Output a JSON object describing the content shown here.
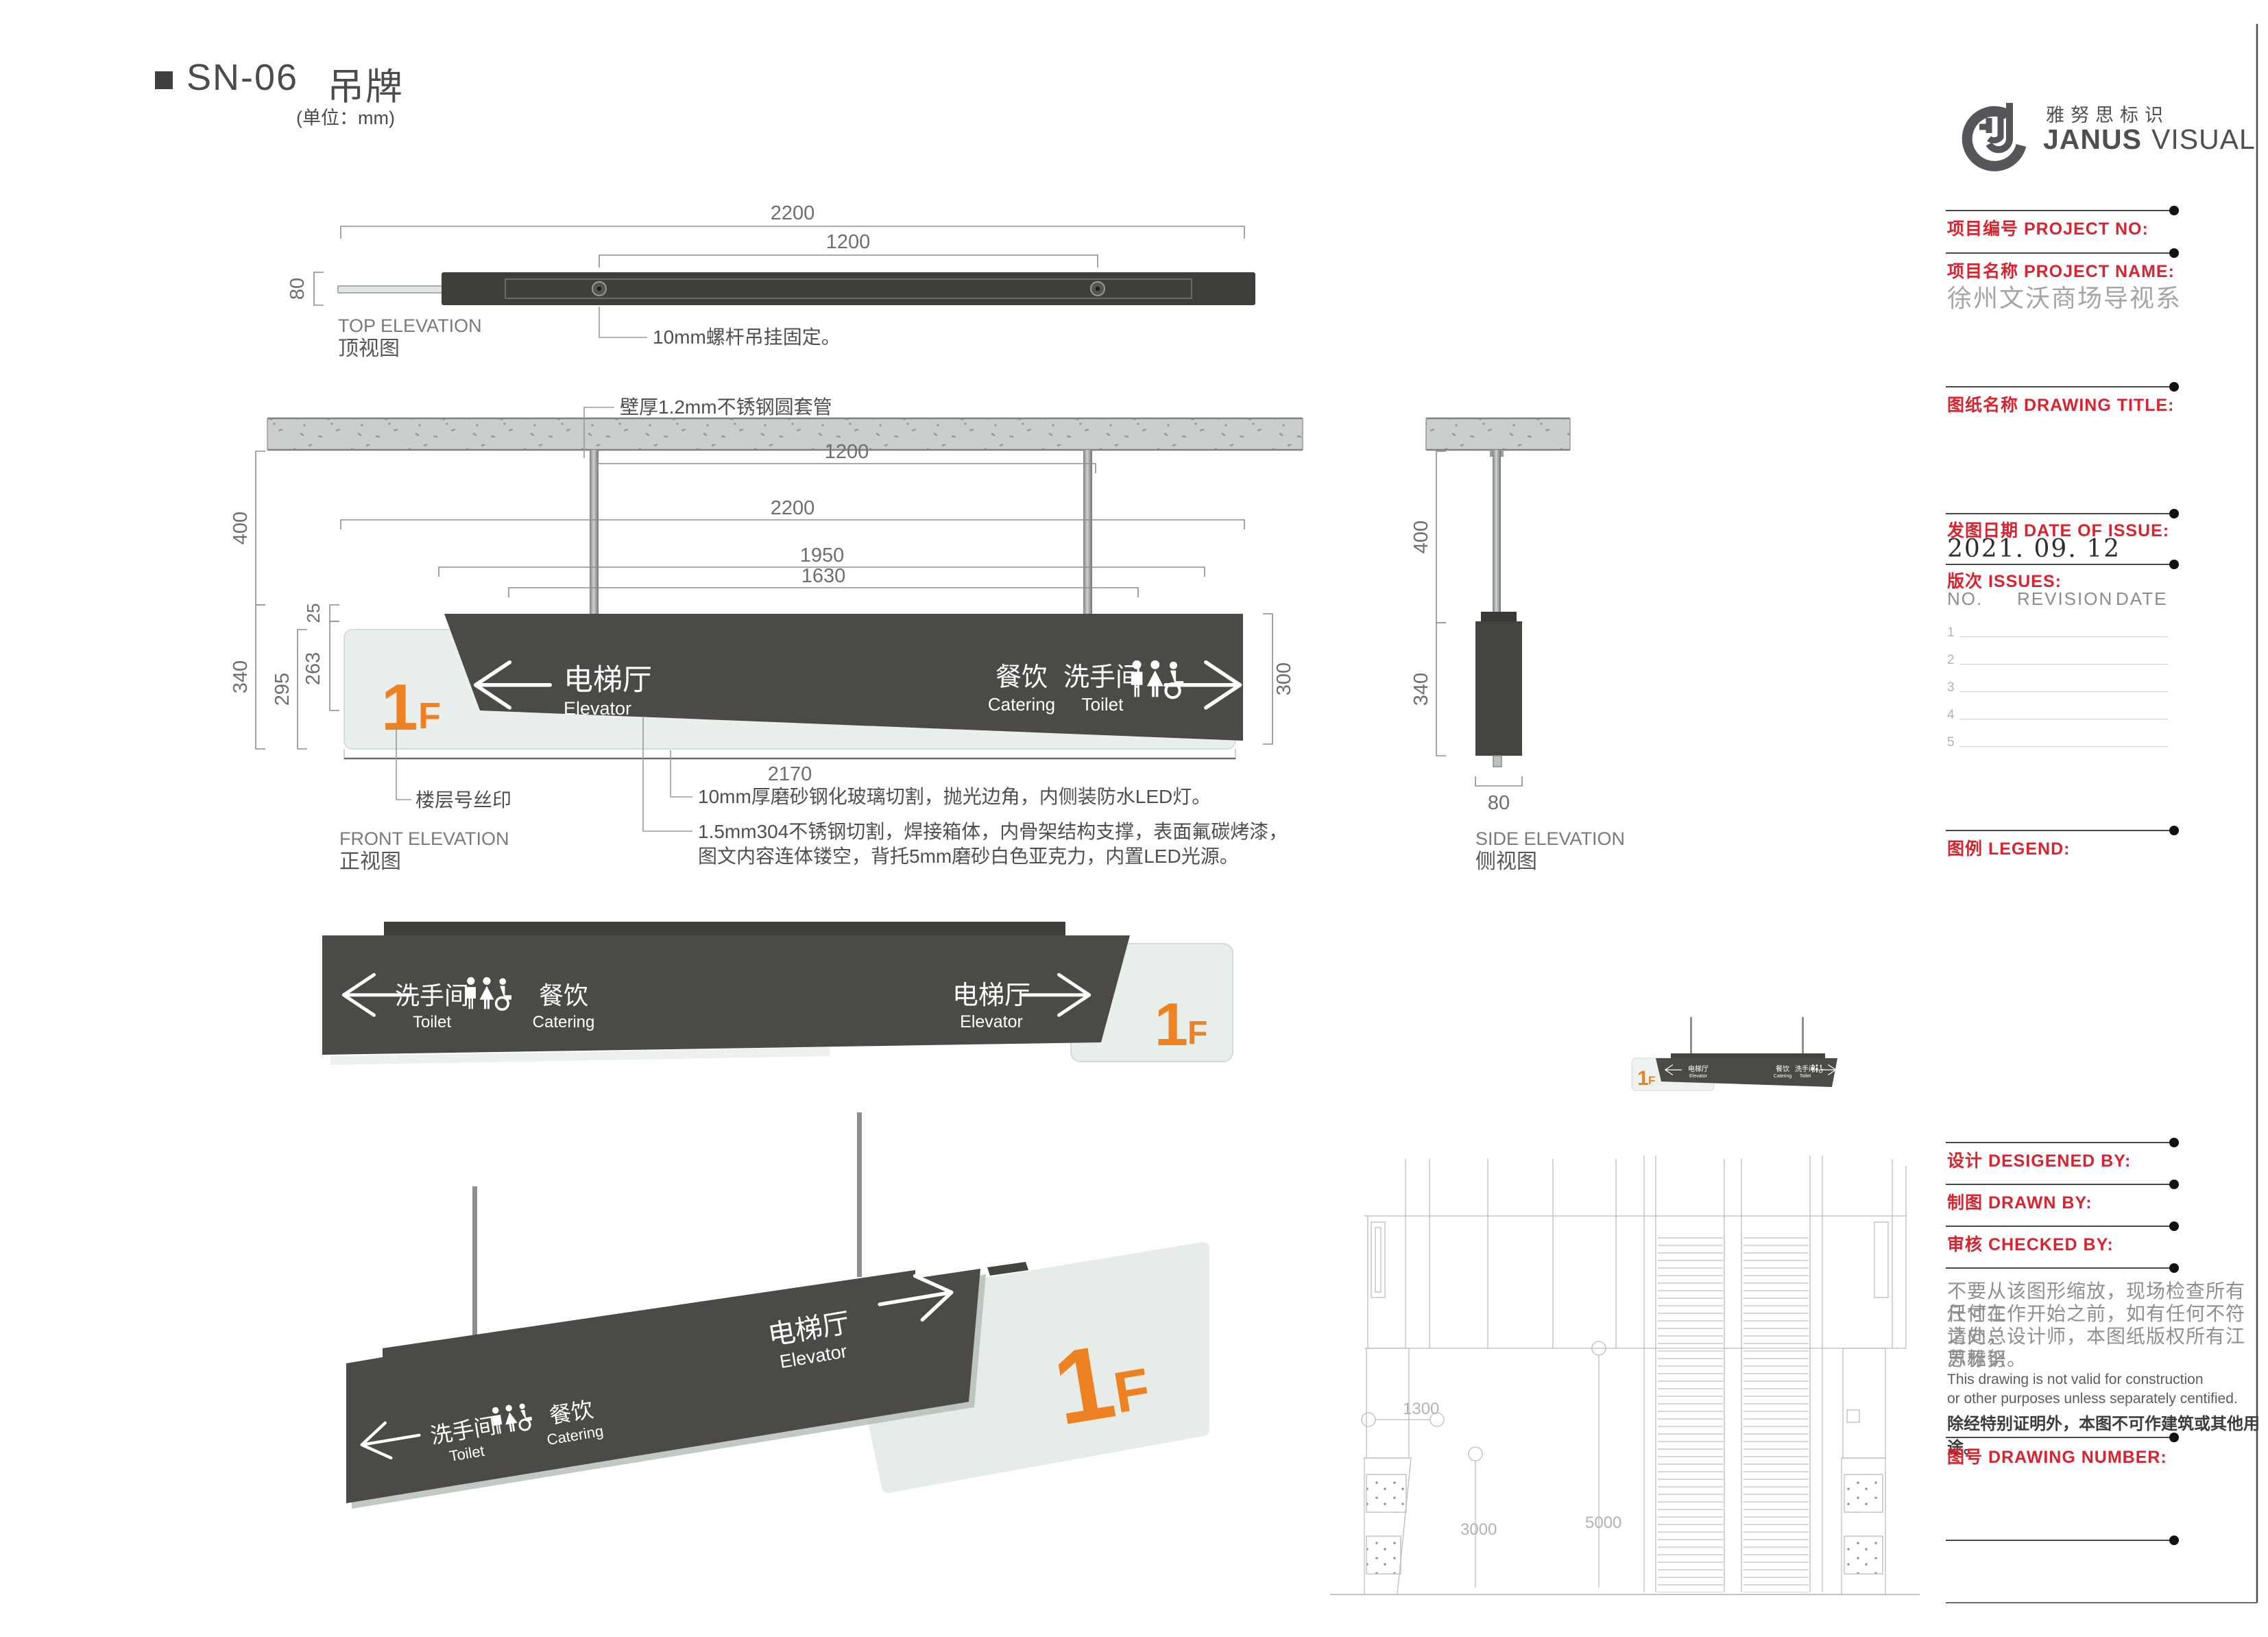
{
  "page": {
    "title_code": "SN-06",
    "title_name": "吊牌",
    "unit": "(单位：mm)"
  },
  "colors": {
    "panel_dark": "#4b4a47",
    "accent_orange": "#ee8121",
    "glass_green": "#e8efeb",
    "label_red": "#d9232e",
    "dim_gray": "#6e6e6c"
  },
  "sign": {
    "floor_num": "1",
    "floor_suffix": "F",
    "elevator_zh": "电梯厅",
    "elevator_en": "Elevator",
    "catering_zh": "餐饮",
    "catering_en": "Catering",
    "toilet_zh": "洗手间",
    "toilet_en": "Toilet"
  },
  "views": {
    "top": {
      "label_en": "TOP ELEVATION",
      "label_zh": "顶视图",
      "dim_width": "2200",
      "dim_hanger": "1200",
      "dim_depth": "80",
      "note_rod": "10mm螺杆吊挂固定。"
    },
    "front": {
      "label_en": "FRONT ELEVATION",
      "label_zh": "正视图",
      "dim_hanger": "1200",
      "dim_width": "2200",
      "dim_1950": "1950",
      "dim_1630": "1630",
      "dim_400": "400",
      "dim_340": "340",
      "dim_295": "295",
      "dim_263": "263",
      "dim_25": "25",
      "dim_300": "300",
      "dim_2170": "2170",
      "note_sleeve": "壁厚1.2mm不锈钢圆套管",
      "note_silkscreen": "楼层号丝印",
      "note_glass": "10mm厚磨砂钢化玻璃切割，抛光边角，内侧装防水LED灯。",
      "note_steel_1": "1.5mm304不锈钢切割，焊接箱体，内骨架结构支撑，表面氟碳烤漆，",
      "note_steel_2": "图文内容连体镂空，背托5mm磨砂白色亚克力，内置LED光源。"
    },
    "side": {
      "label_en": "SIDE ELEVATION",
      "label_zh": "侧视图",
      "dim_400": "400",
      "dim_340": "340",
      "dim_80": "80"
    }
  },
  "cad": {
    "dim_a": "1300",
    "dim_b": "3000",
    "dim_c": "5000"
  },
  "titleblock": {
    "brand_zh": "雅努思标识",
    "brand_en_1": "JANUS",
    "brand_en_2": "VISUAL",
    "project_no_label": "项目编号  PROJECT NO:",
    "project_name_label": "项目名称  PROJECT NAME:",
    "project_name_value": "徐州文沃商场导视系",
    "drawing_title_label": "图纸名称  DRAWING TITLE:",
    "date_label": "发图日期  DATE OF ISSUE:",
    "date_value": "2021. 09. 12",
    "issues_label": "版次  ISSUES:",
    "col_no": "NO.",
    "col_revision": "REVISION",
    "col_date": "DATE",
    "issue_rows": [
      "1",
      "2",
      "3",
      "4",
      "5"
    ],
    "legend_label": "图例  LEGEND:",
    "designed_label": "设计  DESIGENED BY:",
    "drawn_label": "制图  DRAWN BY:",
    "checked_label": "审核  CHECKED BY:",
    "disclaimer_zh_1": "不要从该图形缩放，现场检查所有尺寸在",
    "disclaimer_zh_2": "任何工作开始之前，如有任何不符之处，",
    "disclaimer_zh_3": "请向总设计师，本图纸版权所有江苏雅努",
    "disclaimer_zh_4": "思标识。",
    "disclaimer_en_1": "This drawing is not valid for construction",
    "disclaimer_en_2": "or other purposes unless separately centified.",
    "disclaimer_zh_bold": "除经特别证明外，本图不可作建筑或其他用途。",
    "drawing_number_label": "图号  DRAWING NUMBER:"
  }
}
